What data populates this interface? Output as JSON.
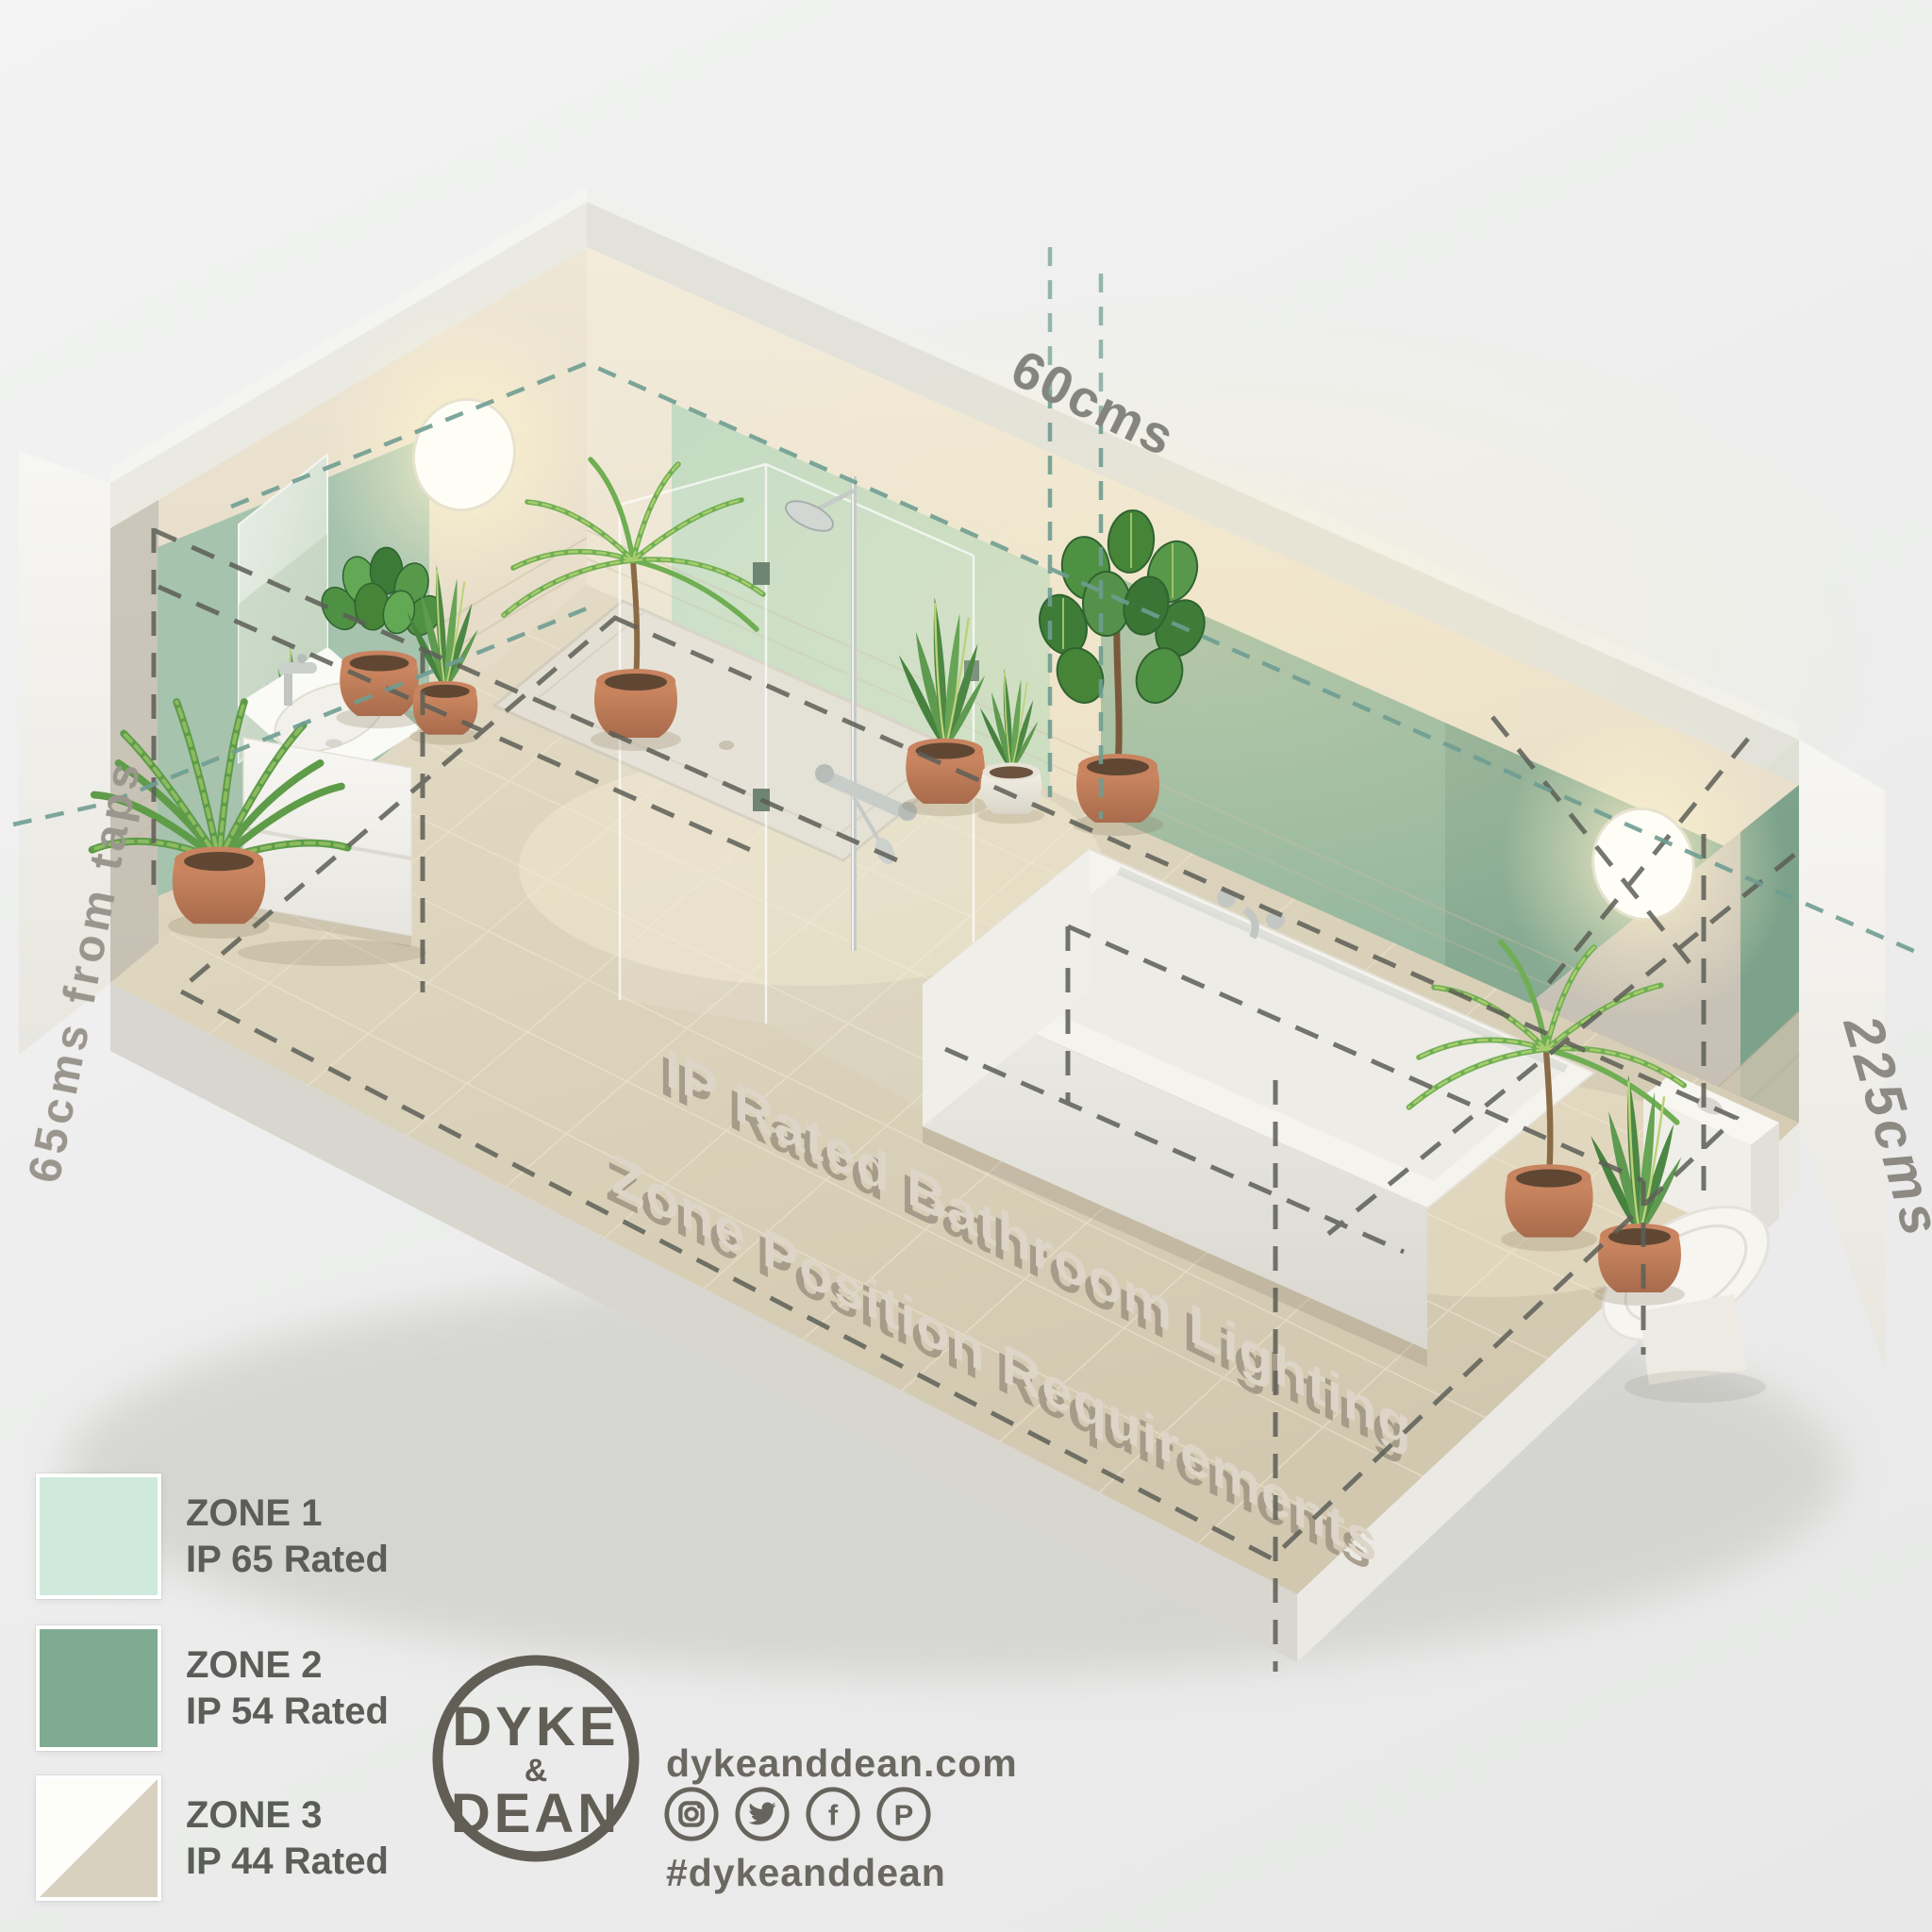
{
  "scene": {
    "floor_title_line1": "IP Rated Bathroom Lighting",
    "floor_title_line2": "Zone Position Requirements",
    "dimension_top": "60cms",
    "dimension_left": "65cms from taps",
    "dimension_right": "225cms"
  },
  "legend": {
    "zones": [
      {
        "label": "ZONE 1",
        "rating": "IP 65 Rated",
        "color": "#cfeadd"
      },
      {
        "label": "ZONE 2",
        "rating": "IP 54 Rated",
        "color": "#7fab93"
      },
      {
        "label": "ZONE 3",
        "rating": "IP 44 Rated",
        "color_top": "#fcfcf9",
        "color_bottom": "#d8d1c0"
      }
    ]
  },
  "footer": {
    "logo_top": "DYKE",
    "logo_amp": "&",
    "logo_bottom": "DEAN",
    "website": "dykeanddean.com",
    "hashtag": "#dykeanddean",
    "social": [
      {
        "name": "instagram"
      },
      {
        "name": "twitter"
      },
      {
        "name": "facebook",
        "glyph": "f"
      },
      {
        "name": "pinterest",
        "glyph": "P"
      }
    ]
  },
  "colors": {
    "zone1": "#cfeadd",
    "zone2": "#7fab93",
    "zone3_beige": "#d8d1c0",
    "dash_dark": "#5d5f57",
    "dash_teal": "#6f9e92",
    "terracotta": "#c8835f",
    "text_gray": "#5b5d58"
  }
}
